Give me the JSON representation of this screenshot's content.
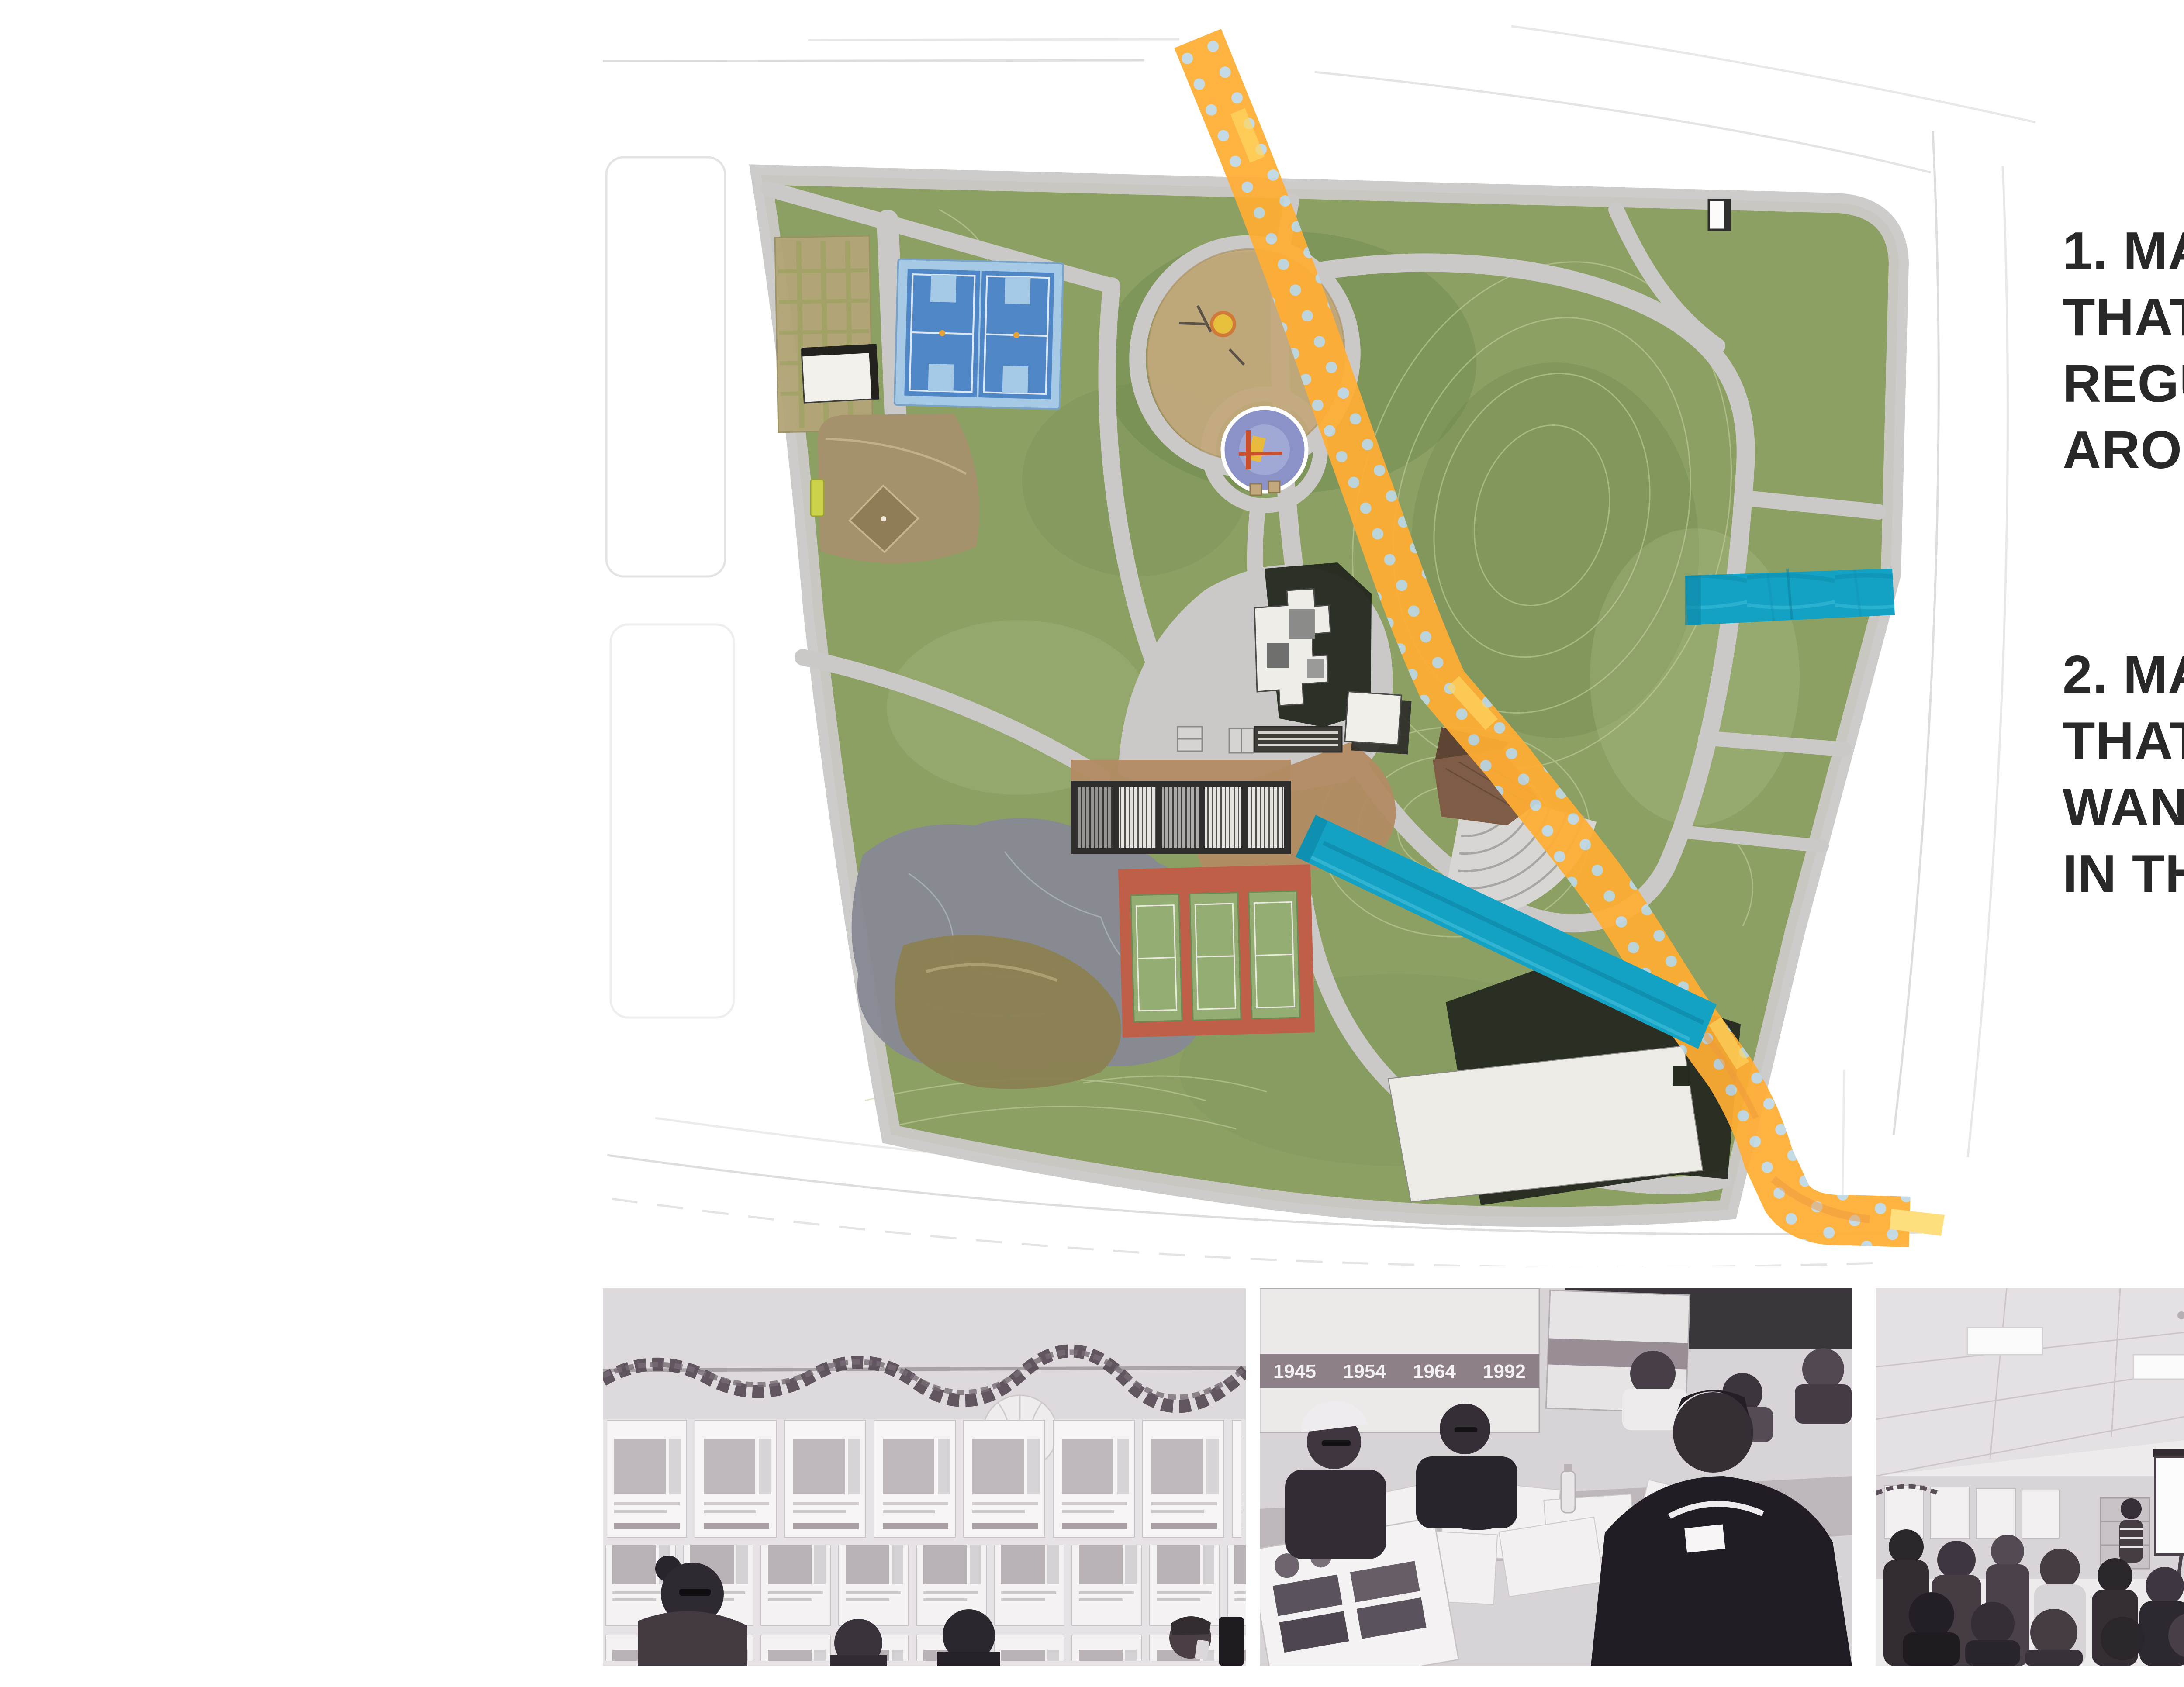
{
  "page": {
    "background": "#ffffff",
    "kind": "community workshop summary page"
  },
  "instructions": [
    {
      "lines": [
        "1. MARK ROUTES",
        "THAT YOU USE",
        "REGULARLY TO GET",
        "AROUND THE PARK"
      ],
      "swatch": "yellow-polka-dot-tape",
      "swatch_color": "#F2E46E"
    },
    {
      "lines": [
        "2. MARK ROUTES",
        "THAT YOU WOULD",
        "WANT TO BE ADDED",
        "IN THE FUTURE"
      ],
      "swatch": "teal-tape",
      "swatch_color": "#14A2C4"
    }
  ],
  "map": {
    "style": "watercolor park site plan with taped route markings",
    "colors": {
      "lawn": "#8CA063",
      "paths": "#CBC9C7",
      "streets": "#ffffff",
      "yellow_tape": "#FFAD33",
      "yellow_tape_dots": "#BFD8E3",
      "teal_tape": "#14A2C4",
      "tennis_red": "#C05F48",
      "basketball_blue": "#4F86C6"
    },
    "features": [
      "community garden plots",
      "maintenance building",
      "basketball courts",
      "baseball diamond",
      "bench",
      "playground",
      "splash pad",
      "great lawn hill",
      "historic house",
      "storage building",
      "picnic shelter",
      "picnic tables",
      "plaza",
      "parking structures",
      "tennis courts",
      "rock outcrop",
      "pond",
      "amphitheater",
      "recreation building",
      "restroom building",
      "perimeter path"
    ]
  },
  "photos": [
    {
      "description": "wall covered with annotated park map sheets, garland and seated residents"
    },
    {
      "description": "residents collaging park maps at a workshop table in front of timeline boards",
      "board_years": [
        "1945",
        "1954",
        "1964",
        "1992"
      ]
    },
    {
      "description": "presentation to seated audience with projection screen"
    },
    {
      "description": "participant viewing wall of posted park maps with paper lantern"
    }
  ]
}
